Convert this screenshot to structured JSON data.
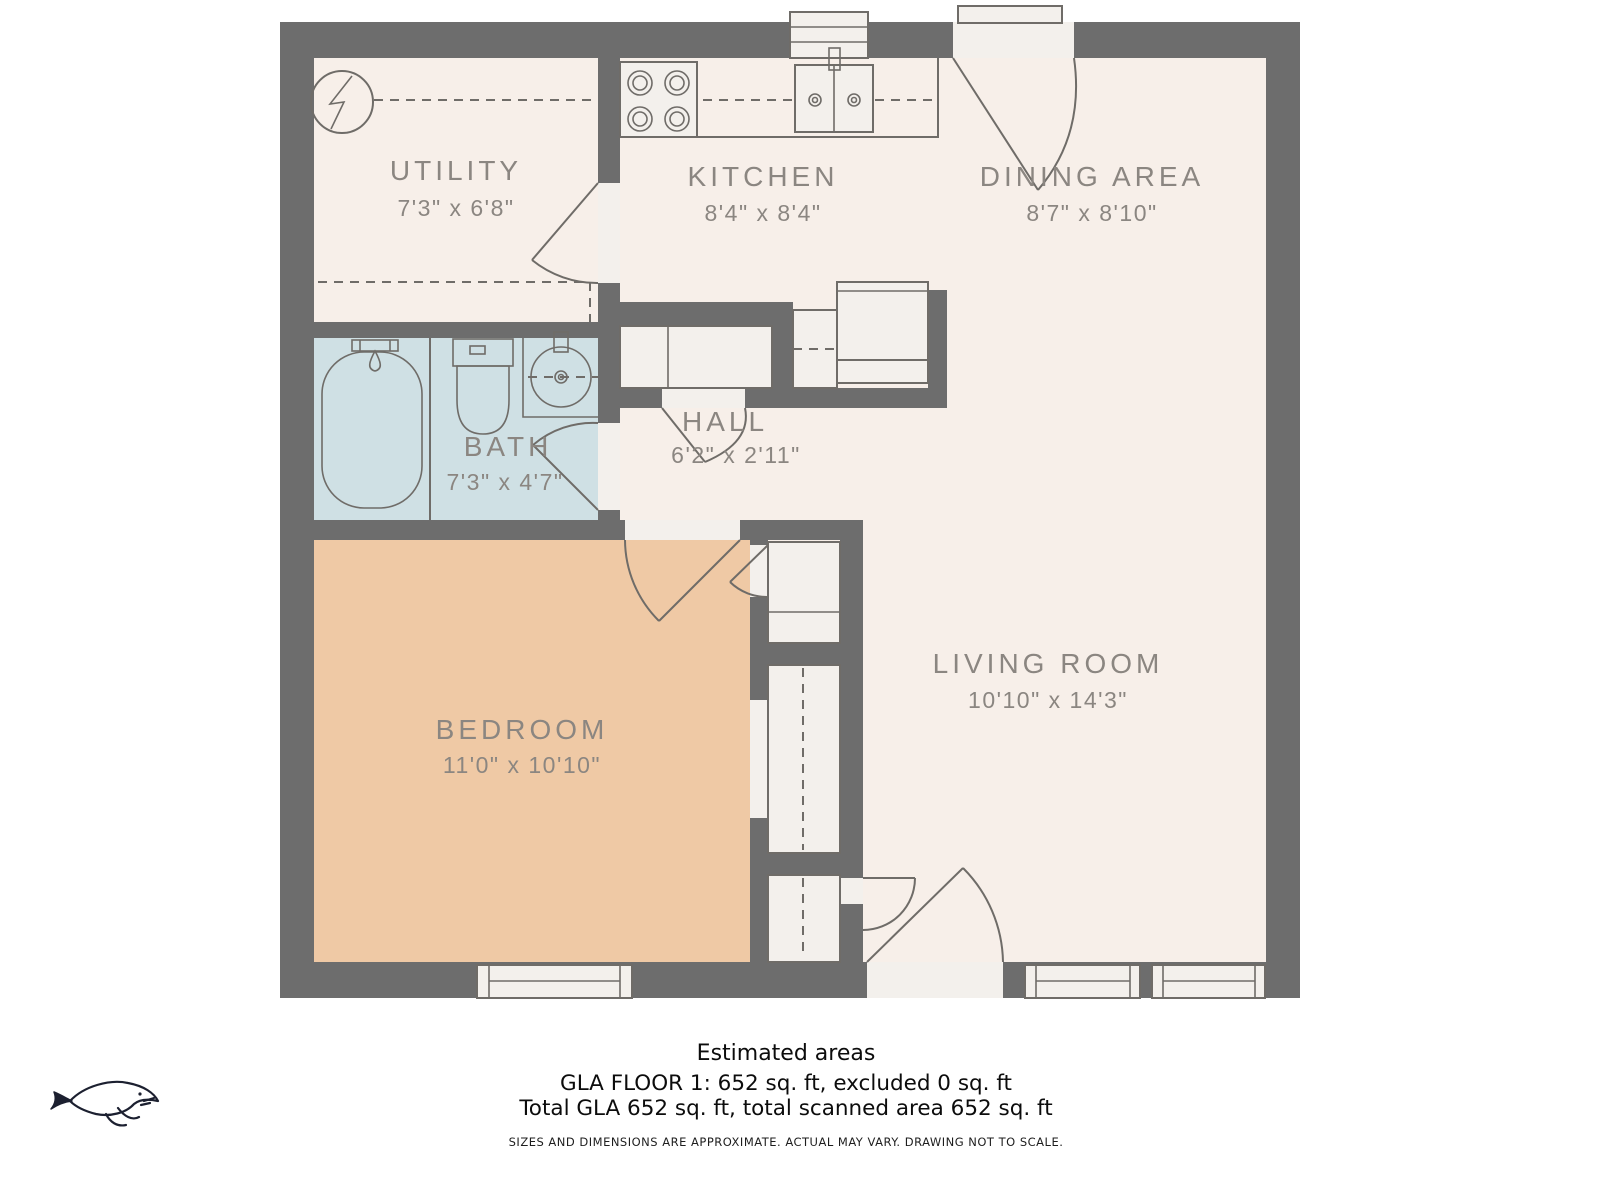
{
  "plan": {
    "rooms": [
      {
        "name": "UTILITY",
        "dims": "7'3\" x 6'8\""
      },
      {
        "name": "KITCHEN",
        "dims": "8'4\" x 8'4\""
      },
      {
        "name": "DINING AREA",
        "dims": "8'7\" x 8'10\""
      },
      {
        "name": "BATH",
        "dims": "7'3\" x 4'7\""
      },
      {
        "name": "HALL",
        "dims": "6'2\" x 2'11\""
      },
      {
        "name": "BEDROOM",
        "dims": "11'0\" x 10'10\""
      },
      {
        "name": "LIVING ROOM",
        "dims": "10'10\" x 14'3\""
      }
    ],
    "colors": {
      "wall": "#6d6d6d",
      "floor": "#f7efe9",
      "bath_floor": "#cfe0e4",
      "bedroom_floor": "#efc9a5",
      "label_text": "#8b8681",
      "fixture_line": "#6f6c68",
      "logo_ink": "#1c2030"
    },
    "icons": [
      "electrical-panel-icon",
      "stove-icon",
      "kitchen-sink-icon",
      "bathtub-icon",
      "toilet-icon",
      "bathroom-sink-icon",
      "whale-logo"
    ]
  },
  "footer": {
    "heading": "Estimated areas",
    "line1": "GLA FLOOR 1: 652 sq. ft, excluded 0 sq. ft",
    "line2": "Total GLA 652 sq. ft, total scanned area 652 sq. ft",
    "disclaimer": "SIZES AND DIMENSIONS ARE APPROXIMATE. ACTUAL MAY VARY. DRAWING NOT TO SCALE."
  }
}
